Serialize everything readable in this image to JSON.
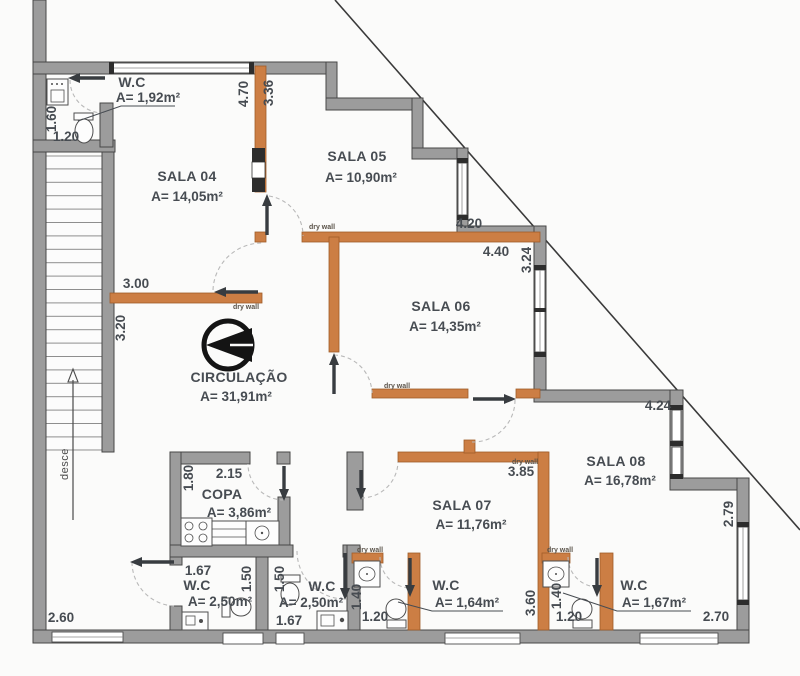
{
  "plan": {
    "rooms": [
      {
        "id": "wc-entry",
        "name": "W.C",
        "area": "A= 1,92m²"
      },
      {
        "id": "sala-04",
        "name": "SALA 04",
        "area": "A= 14,05m²"
      },
      {
        "id": "sala-05",
        "name": "SALA 05",
        "area": "A= 10,90m²"
      },
      {
        "id": "sala-06",
        "name": "SALA 06",
        "area": "A= 14,35m²"
      },
      {
        "id": "circulacao",
        "name": "CIRCULAÇÃO",
        "area": "A= 31,91m²"
      },
      {
        "id": "copa",
        "name": "COPA",
        "area": "A= 3,86m²"
      },
      {
        "id": "sala-07",
        "name": "SALA 07",
        "area": "A= 11,76m²"
      },
      {
        "id": "sala-08",
        "name": "SALA 08",
        "area": "A= 16,78m²"
      },
      {
        "id": "wc-1",
        "name": "W.C",
        "area": "A= 2,50m²"
      },
      {
        "id": "wc-2",
        "name": "W.C",
        "area": "A= 2,50m²"
      },
      {
        "id": "wc-3",
        "name": "W.C",
        "area": "A= 1,64m²"
      },
      {
        "id": "wc-4",
        "name": "W.C",
        "area": "A= 1,67m²"
      }
    ],
    "dimensions": [
      "1.60",
      "1.20",
      "4.70",
      "3.36",
      "3.00",
      "3.20",
      "4.20",
      "4.40",
      "3.24",
      "4.24",
      "2.79",
      "2.70",
      "3.85",
      "1.80",
      "2.15",
      "1.67",
      "1.50",
      "1.50",
      "1.67",
      "1.20",
      "1.40",
      "3.60",
      "1.40",
      "1.20",
      "2.60"
    ],
    "annotations": {
      "stairs_direction": "desce",
      "dry_wall": "dry wall"
    },
    "colors": {
      "wall_gray": "#9c9c9c",
      "dry_wall_orange": "#cc7e44",
      "door_dark": "#383c40",
      "text": "#474c52"
    }
  }
}
